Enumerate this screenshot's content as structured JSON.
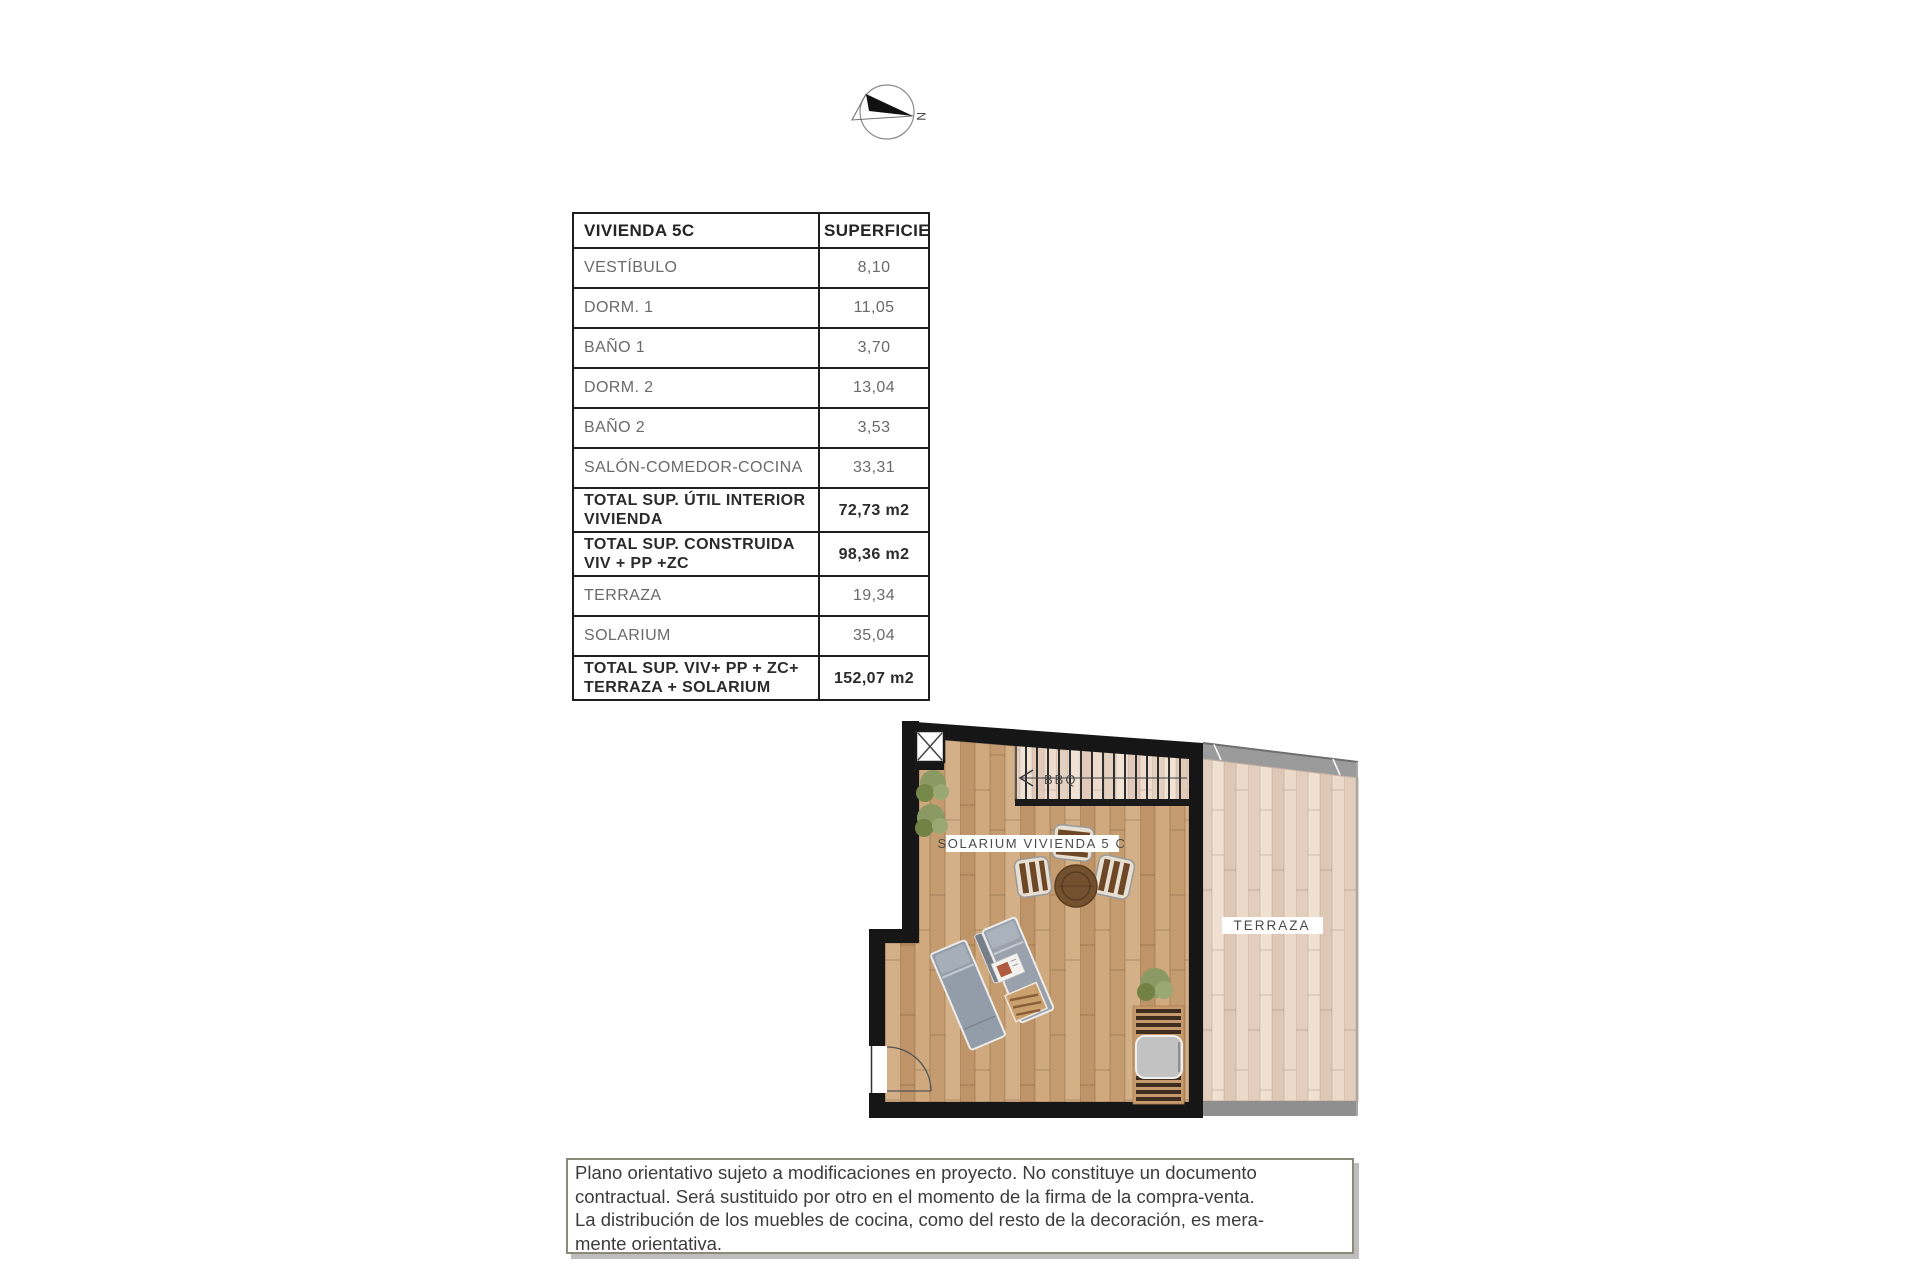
{
  "compass": {
    "north_label": "N"
  },
  "area_table": {
    "header": {
      "title": "VIVIENDA 5C",
      "surface": "SUPERFICIE"
    },
    "rows": [
      {
        "label": "VESTÍBULO",
        "value": "8,10",
        "is_total": false
      },
      {
        "label": "DORM. 1",
        "value": "11,05",
        "is_total": false
      },
      {
        "label": "BAÑO 1",
        "value": "3,70",
        "is_total": false
      },
      {
        "label": "DORM. 2",
        "value": "13,04",
        "is_total": false
      },
      {
        "label": "BAÑO 2",
        "value": "3,53",
        "is_total": false
      },
      {
        "label": "SALÓN-COMEDOR-COCINA",
        "value": "33,31",
        "is_total": false
      },
      {
        "label": "TOTAL SUP. ÚTIL INTERIOR VIVIENDA",
        "value": "72,73 m2",
        "is_total": true
      },
      {
        "label": "TOTAL SUP. CONSTRUIDA VIV + PP +ZC",
        "value": "98,36 m2",
        "is_total": true
      },
      {
        "label": "TERRAZA",
        "value": "19,34",
        "is_total": false
      },
      {
        "label": "SOLARIUM",
        "value": "35,04",
        "is_total": false
      },
      {
        "label": "TOTAL SUP. VIV+ PP + ZC+ TERRAZA + SOLARIUM",
        "value": "152,07 m2",
        "is_total": true
      }
    ]
  },
  "floor_plan": {
    "labels": {
      "solarium": "SOLARIUM VIVIENDA 5 C",
      "terraza": "TERRAZA",
      "stairs": "BBQ"
    },
    "colors": {
      "wall": "#161616",
      "solarium_floor": "#c79e73",
      "terraza_floor": "#e8d5c6",
      "roof_band": "#9b9b9b"
    }
  },
  "disclaimer": {
    "lines": [
      "Plano orientativo sujeto a modificaciones en proyecto. No constituye un documento",
      "contractual. Será sustituido por otro en el momento de la firma de la compra-venta.",
      "La distribución de los muebles de cocina, como del resto de la decoración, es mera-",
      "mente orientativa."
    ]
  }
}
